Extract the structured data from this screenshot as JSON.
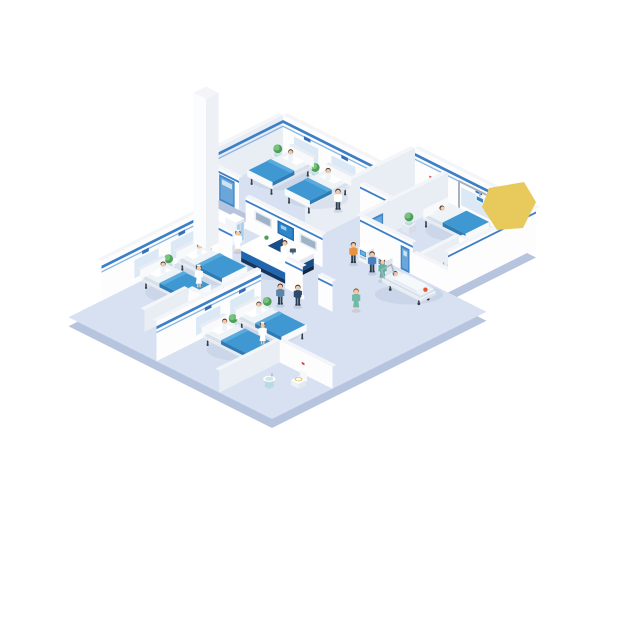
{
  "illustration": {
    "title": "Isometric hospital ward floor illustration",
    "background": "#ffffff"
  },
  "palette": {
    "floor": "#d7e1f1",
    "floorEdge": "#b7c4de",
    "wallFace": "#fdfdfe",
    "wallShade": "#e9edf4",
    "wallTop": "#f3f5f9",
    "stripe": "#3c7fc6",
    "stripeLight": "#8ab6e2",
    "panelBlue": "#dbe8f6",
    "signBlue": "#2f6fbe",
    "mattress": "#3f98d2",
    "mattressSide": "#2e7cb5",
    "mattressFold": "#5aabdd",
    "sheet": "#eef3f8",
    "sheetSide": "#d7e1eb",
    "bedFrame": "#f7f9fb",
    "bedLeg": "#3a4048",
    "doorBlue": "#3e86c8",
    "doorBlueLight": "#6aa6d9",
    "glass": "#a9cdec",
    "deskNavy": "#16355d",
    "deskBlue": "#1f66b0",
    "deskSideBlue": "#174e88",
    "deskSideNavy": "#0f2747",
    "deskWhite": "#ffffff",
    "screenBlue": "#2f86c9",
    "screenBlueDeep": "#1f6db3",
    "screenGray": "#9fb3c8",
    "monitorFrame": "#e8edf3",
    "yellow": "#e8c95c",
    "plantDark": "#4f9e58",
    "plantLight": "#74c47e",
    "plantStand": "#eef1f6",
    "sinkTeal": "#cfe6ea",
    "sinkTealDeep": "#b9dae0",
    "toiletSeat": "#e2cb6e",
    "artRed": "#d64545",
    "shadow": "#7d93bd",
    "skin": "#f2c9a4",
    "hairDark": "#47342a",
    "hairRed": "#a34f2e",
    "coatWhite": "#ffffff",
    "scrubTeal": "#5fb3a1",
    "scrubGreen": "#74b9a5",
    "shirtOrange": "#e8923a",
    "jacketBlue": "#4a7fc1",
    "suitNavy": "#2d4a6b",
    "pantsDark": "#2c3e50",
    "gown": "#eef4fa",
    "uniformBlue": "#5b84a8",
    "metal": "#a7b2c0",
    "wheel": "#3a4048",
    "redItem": "#e0582f"
  },
  "reception": {
    "sign_label": "P&H",
    "staff_count": 1
  },
  "rooms": [
    {
      "name": "top-ward",
      "beds": 2,
      "patients": 2,
      "staff": "doctor",
      "plants": 2
    },
    {
      "name": "right-ward",
      "beds": 1,
      "patients": 1,
      "staff": "doctor",
      "plants": 1,
      "bathroom": [
        "sink",
        "toilet"
      ]
    },
    {
      "name": "left-ward",
      "beds": 2,
      "patients": 2,
      "staff": "nurse",
      "plants": 2,
      "bathroom": [
        "sink",
        "toilet"
      ]
    },
    {
      "name": "bottom-ward",
      "beds": 2,
      "patients": 2,
      "staff": "nurse",
      "plants": 2,
      "bathroom": [
        "sink",
        "toilet"
      ]
    },
    {
      "name": "utility-room",
      "fixtures": [
        "hand-basin",
        "wall-art"
      ]
    }
  ],
  "lobby": {
    "wall_screens": [
      "monitor",
      "x-ray-display",
      "monitor"
    ],
    "kiosks": 2,
    "kiosk_users": 2,
    "medical_cabinet": 1,
    "stretcher": {
      "patient": 1,
      "nurse": 1
    },
    "walking_people": [
      "orderly",
      "assistant",
      "nurse"
    ]
  },
  "accent": {
    "yellow_shape": "#e8c95c"
  }
}
